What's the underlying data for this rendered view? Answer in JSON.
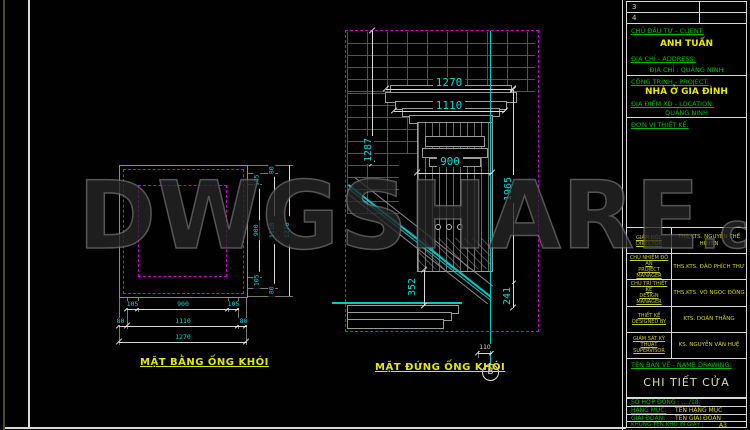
{
  "watermark": {
    "main": "DWGSHARE",
    "suffix": ".com"
  },
  "plan": {
    "label": "MẶT BẰNG ỐNG KHÓI",
    "bottom": [
      [
        "105",
        "900",
        "105"
      ],
      [
        "80",
        "1110",
        "80"
      ],
      [
        "1270"
      ]
    ],
    "right": [
      [
        "105",
        "900",
        "105"
      ],
      [
        "80",
        "1110",
        "80"
      ],
      [
        "1270"
      ]
    ]
  },
  "elevation": {
    "label": "MẶT ĐỨNG ỐNG KHÓI",
    "grid_bubble": "B",
    "dims": {
      "top_width": "1270",
      "cap_width": "1110",
      "body_width": "900",
      "left_height": "1287",
      "right_height": "1965",
      "roof_drop": "352",
      "eave_offset": "241",
      "grid_offset": "110"
    }
  },
  "title_block": {
    "revisions": [
      {
        "no": "3"
      },
      {
        "no": "4"
      }
    ],
    "client_label": "CHỦ ĐẦU TƯ - CLIENT:",
    "client_name": "ANH TUẤN",
    "address_label": "ĐỊA CHỈ - ADDRESS:",
    "address_value": "ĐỊA CHỈ : QUẢNG NINH",
    "project_label": "CÔNG TRÌNH - PROJECT:",
    "project_name": "NHÀ Ở GIA ĐÌNH",
    "site_label": "ĐỊA ĐIỂM XD - LOCATION:",
    "site_value": "QUẢNG NINH",
    "designer_label": "ĐƠN VỊ THIẾT KẾ:",
    "personnel": [
      {
        "role": "GIÁM ĐỐC",
        "role_en": "DIRECTOR",
        "name": "THS.KTS. NGUYỄN THẾ HUYỀN"
      },
      {
        "role": "CHỦ NHIỆM ĐỒ ÁN",
        "role_en": "PROJECT MANAGER",
        "name": "THS.KTS. ĐÀO PHÍCH THƯ"
      },
      {
        "role": "CHỦ TRÌ THIẾT KẾ",
        "role_en": "DESIGN MANAGER",
        "name": "THS.KTS. VÕ NGỌC ĐÔNG"
      },
      {
        "role": "THIẾT KẾ",
        "role_en": "DESIGNED BY",
        "name": "KTS. DOÃN THẮNG"
      },
      {
        "role": "GIÁM SÁT KỸ THUẬT",
        "role_en": "SUPERVISOR",
        "name": "KS. NGUYỄN VĂN HUỆ"
      }
    ],
    "drawing_name_label": "TÊN BẢN VẼ - NAME DRAWING:",
    "drawing_name": "CHI TIẾT CỬA",
    "contract_label": "SỐ HỢP ĐỒNG : ..../18.",
    "category_label": "HẠNG MỤC:",
    "category_value": "TÊN HẠNG MỤC",
    "stage_label": "GIAI ĐOẠN:",
    "stage_value": "TÊN GIAI ĐOẠN",
    "paper_label": "KHUNG TÊN KHỔ IN GIẤY :",
    "paper_value": "A3"
  }
}
